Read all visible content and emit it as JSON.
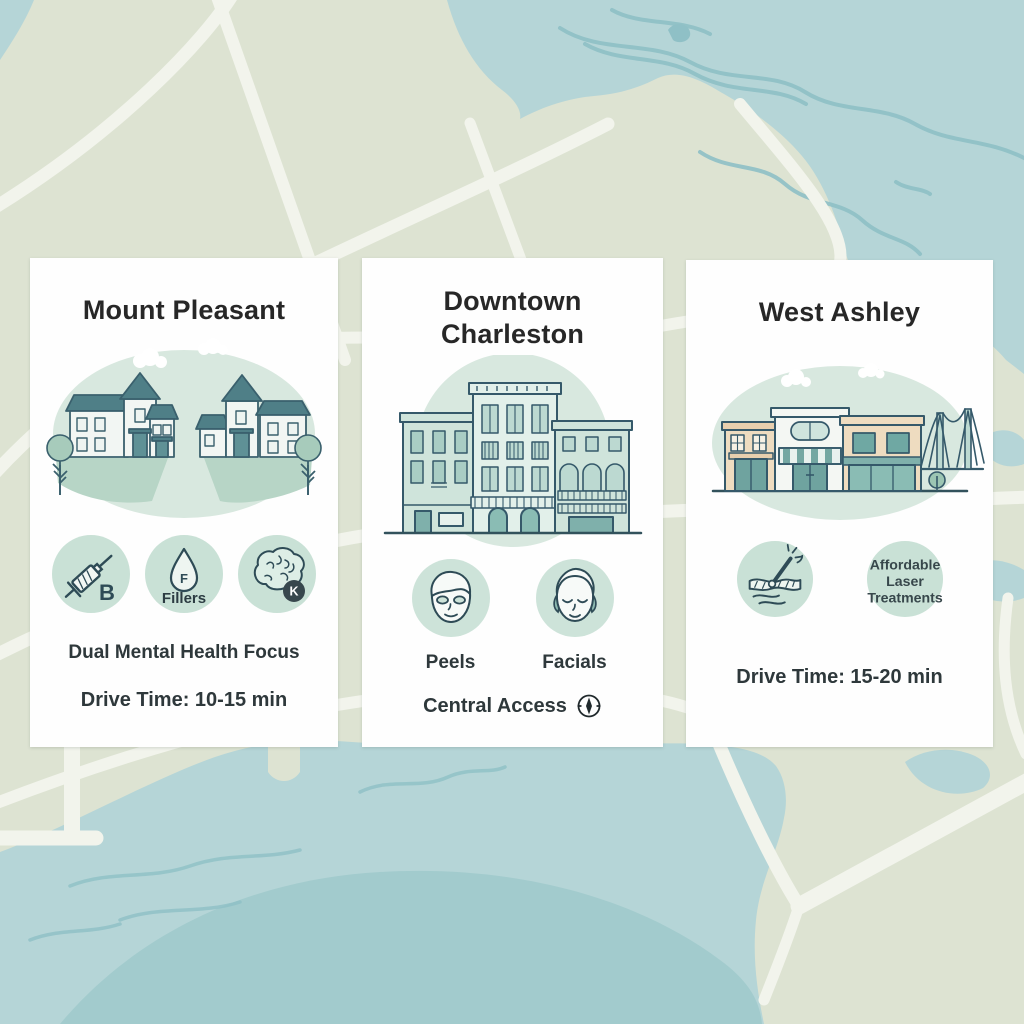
{
  "map": {
    "land_color": "#dde3d2",
    "water_color": "#b5d5d7",
    "water_deep_color": "#a2cbcd",
    "stream_color": "#8fc0c6",
    "road_color": "#f2f4ec"
  },
  "accent": {
    "icon_circle": "#c9e1d6",
    "illustration_bg": "#d8e8df",
    "line_ink": "#2e4b56"
  },
  "cards": [
    {
      "title": "Mount Pleasant",
      "icons": [
        {
          "name": "syringe-icon",
          "letter": "B"
        },
        {
          "name": "droplet-icon",
          "letter": "F",
          "label": "Fillers"
        },
        {
          "name": "brain-icon",
          "badge": "K"
        }
      ],
      "feature": "Dual Mental Health Focus",
      "drive_time": "Drive Time: 10-15 min"
    },
    {
      "title_line1": "Downtown",
      "title_line2": "Charleston",
      "icons": [
        {
          "name": "peel-mask-face-icon",
          "label": "Peels"
        },
        {
          "name": "facial-face-icon",
          "label": "Facials"
        }
      ],
      "footer": "Central Access"
    },
    {
      "title": "West Ashley",
      "icons": [
        {
          "name": "laser-skin-icon"
        },
        {
          "name": "laser-text-bubble",
          "line1": "Affordable",
          "line2": "Laser",
          "line3": "Treatments"
        }
      ],
      "drive_time": "Drive Time: 15-20 min"
    }
  ]
}
